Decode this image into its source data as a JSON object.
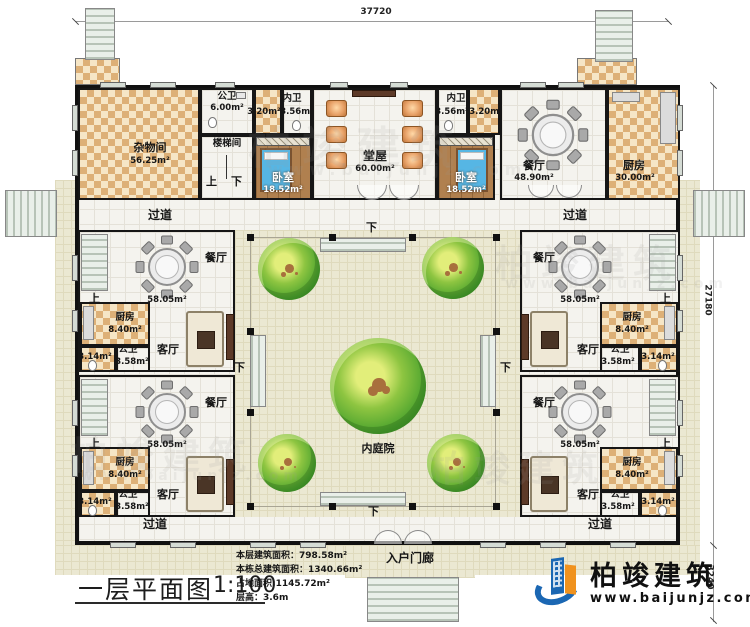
{
  "plan": {
    "title": "一层平面图",
    "scale": "1:100"
  },
  "dimensions": {
    "width": "37720",
    "height": "27180",
    "porch_depth": "3240"
  },
  "stats": {
    "lines": [
      "本层建筑面积：798.58m²",
      "本栋总建筑面积：1340.66m²",
      "占地面积:1145.72m²",
      "层高：3.6m"
    ]
  },
  "brand": {
    "name": "柏竣建筑",
    "website": "www.baijunjz.com"
  },
  "watermark": {
    "text": "柏竣建筑",
    "url": "www.baijunjz.com"
  },
  "labels": {
    "corridor": "过道",
    "up": "上",
    "down": "下",
    "courtyard": "内庭院",
    "entry_porch": "入户门廊"
  },
  "rooms": {
    "storage": {
      "label": "杂物间",
      "area": "56.25m²"
    },
    "public_bath": {
      "label": "公卫",
      "area": "6.00m²"
    },
    "stair_hall": {
      "label": "楼梯间"
    },
    "ensuite": {
      "label": "内卫",
      "area_small": "3.20m²",
      "area_large": "3.56m²"
    },
    "bedroom": {
      "label": "卧室",
      "area": "18.52m²"
    },
    "main_hall": {
      "label": "堂屋",
      "area": "60.00m²"
    },
    "dining_main": {
      "label": "餐厅",
      "area": "48.90m²"
    },
    "kitchen_main": {
      "label": "厨房",
      "area": "30.00m²"
    },
    "wing_dining": {
      "label": "餐厅",
      "area": "58.05m²"
    },
    "wing_kitchen": {
      "label": "厨房",
      "area": "8.40m²"
    },
    "wing_bath": {
      "label": "公卫",
      "area_large": "3.58m²",
      "area_small": "3.14m²"
    },
    "wing_living": {
      "label": "客厅"
    }
  }
}
